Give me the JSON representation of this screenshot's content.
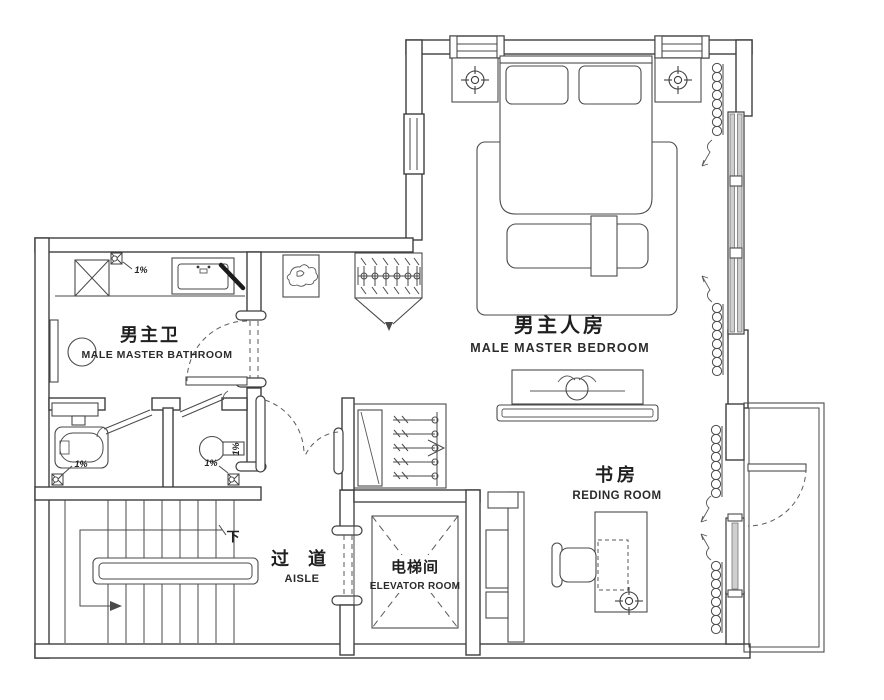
{
  "drawing": {
    "kind": "residential floor plan",
    "colors": {
      "background": "#ffffff",
      "wall_line": "#3e3e3e",
      "glazing": "#cfcfcf",
      "text": "#1f1f1f"
    }
  },
  "rooms": {
    "master_bathroom": {
      "zh": "男主卫",
      "en": "MALE MASTER BATHROOM"
    },
    "master_bedroom": {
      "zh": "男主人房",
      "en": "MALE MASTER BEDROOM"
    },
    "reading_room": {
      "zh": "书房",
      "en": "REDING ROOM"
    },
    "aisle": {
      "zh": "过 道",
      "en": "AISLE"
    },
    "elevator_room": {
      "zh": "电梯间",
      "en": "ELEVATOR ROOM"
    }
  },
  "annotations": {
    "stair_direction": "下",
    "slope_counter": "1%",
    "slope_bathtub": "1%",
    "slope_toilet_floor": "1%",
    "slope_toilet_side": "1%"
  },
  "symbols": [
    "floor-drain",
    "downlight",
    "curtain-coil",
    "clothes-hanger",
    "door-swing",
    "bathtub",
    "toilet",
    "washing-machine",
    "vanity-sink",
    "double-bed",
    "pillow",
    "nightstand",
    "rug",
    "bench",
    "tv-cabinet",
    "desk",
    "chair",
    "stairs",
    "elevator-shaft",
    "wardrobe",
    "decor-object",
    "window",
    "balcony-railing"
  ]
}
